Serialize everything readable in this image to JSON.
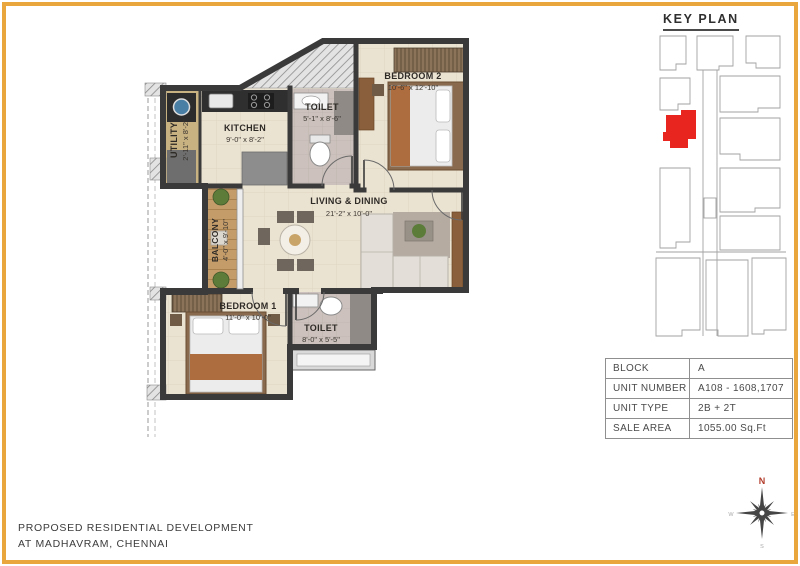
{
  "key_plan": {
    "title": "KEY PLAN",
    "highlight_color": "#e8251f"
  },
  "floor_plan": {
    "rooms": [
      {
        "id": "utility",
        "name": "UTILITY",
        "dims": "2'-11\" x 8'-2\""
      },
      {
        "id": "kitchen",
        "name": "KITCHEN",
        "dims": "9'-0\" x 8'-2\""
      },
      {
        "id": "toilet-top",
        "name": "TOILET",
        "dims": "5'-1\" x 8'-6\""
      },
      {
        "id": "bedroom-2",
        "name": "BEDROOM 2",
        "dims": "10'-6\" x 12'-10\""
      },
      {
        "id": "living-dining",
        "name": "LIVING & DINING",
        "dims": "21'-2\" x 10'-0\""
      },
      {
        "id": "balcony",
        "name": "BALCONY",
        "dims": "4'-0\" x 9'-10\""
      },
      {
        "id": "bedroom-1",
        "name": "BEDROOM 1",
        "dims": "11'-0\" x 10'-0\""
      },
      {
        "id": "toilet-bottom",
        "name": "TOILET",
        "dims": "8'-0\" x 5'-5\""
      }
    ],
    "colors": {
      "wall": "#3a3a3a",
      "floor": "#ebe3d2",
      "toilet_floor": "#ccc1bc",
      "utility_floor": "#c8b282",
      "balcony_floor": "#c49c6a"
    }
  },
  "unit_table": {
    "rows": [
      {
        "label": "BLOCK",
        "value": "A"
      },
      {
        "label": "UNIT NUMBER",
        "value": "A108 - 1608,1707"
      },
      {
        "label": "UNIT TYPE",
        "value": "2B + 2T"
      },
      {
        "label": "SALE AREA",
        "value": "1055.00 Sq.Ft"
      }
    ]
  },
  "footer": {
    "line1": "PROPOSED RESIDENTIAL DEVELOPMENT",
    "line2": "AT MADHAVRAM, CHENNAI"
  },
  "compass": {
    "n": "N",
    "e": "E",
    "s": "S",
    "w": "W"
  },
  "page": {
    "frame_color": "#e8a63c"
  }
}
